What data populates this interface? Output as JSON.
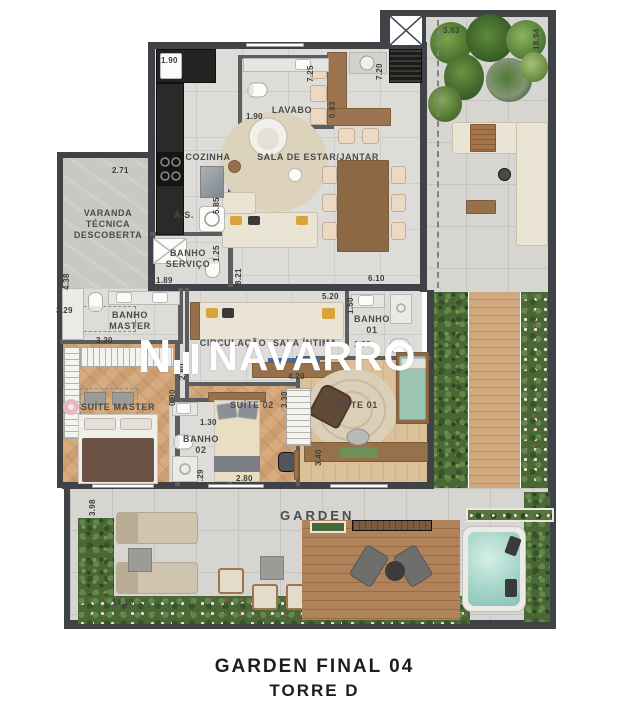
{
  "plan": {
    "rooms": {
      "lavabo": "LAVABO",
      "cozinha": "COZINHA",
      "sala_estar": "SALA DE ESTAR/JANTAR",
      "varanda": "VARANDA TÉCNICA DESCOBERTA",
      "area_servico": "A.S.",
      "banho_servico": "BANHO SERVIÇO",
      "banho_master": "BANHO MASTER",
      "suite_master": "SUÍTE MASTER",
      "circulacao": "CIRCULAÇÃO",
      "sala_intima": "SALA ÍNTIMA",
      "banho_01": "BANHO 01",
      "suite_01": "SUÍTE 01",
      "suite_02": "SUÍTE 02",
      "banho_02": "BANHO 02",
      "garden": "GARDEN"
    },
    "dims": {
      "kitchen_top": "1.90",
      "lavabo_w": "1.90",
      "lavabo_h": "0.93",
      "sala_h_left": "7.25",
      "sala_h_right": "7.20",
      "terrace_top": "3.63",
      "right_total": "18.94",
      "varanda_top": "2.71",
      "varanda_h": "4.38",
      "as_h": "5.85",
      "banho_servico_h": "1.25",
      "banho_servico_w": "1.89",
      "servico_wall": "8.21",
      "sala_w": "6.10",
      "sala_intima_w": "5.20",
      "banho01_h": "1.50",
      "banho01_w": "1.80",
      "banho_master_w": "3.29",
      "suite_master_w": "3.30",
      "circulacao_h": "2.80",
      "hall_h": "0.90",
      "suite02_top": "4.20",
      "suite02_h": "3.30",
      "banho02_w": "1.30",
      "banho02_h": "2.29",
      "suite02_w": "2.80",
      "suite01_h": "3.40",
      "garden_h": "3.98",
      "garden_w": "14.19"
    },
    "watermark": "NAVARRO",
    "caption_line1": "GARDEN  FINAL 04",
    "caption_line2": "TORRE D",
    "colors": {
      "wall": "#3f4347",
      "tile": "#dedcd8",
      "wood_floor": "#d3a878",
      "deck": "#ab7d52",
      "hedge": "#4a6836",
      "water": "#a5d4c9",
      "sofa": "#e9e4d3",
      "accent_cushion": "#d9a43a"
    }
  }
}
